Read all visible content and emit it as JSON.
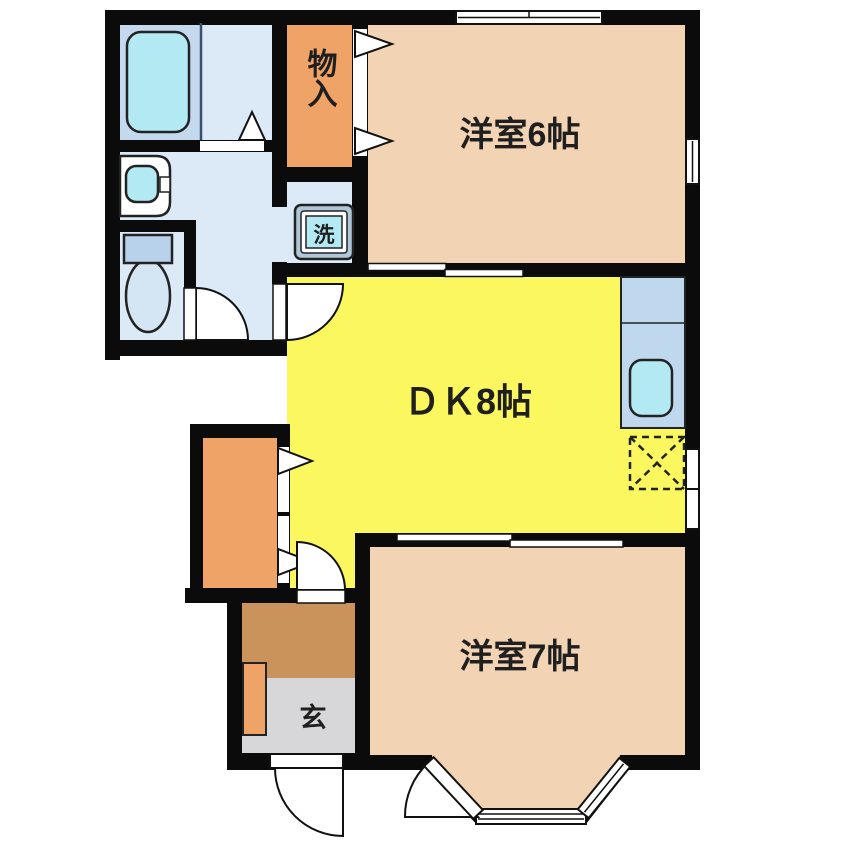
{
  "floor_plan": {
    "rooms": {
      "western6": {
        "label": "洋室6帖"
      },
      "dk": {
        "label": "ＤＫ8帖"
      },
      "western7": {
        "label": "洋室7帖"
      },
      "storage": {
        "label": "物入"
      },
      "laundry": {
        "label": "洗"
      },
      "entrance": {
        "label": "玄"
      }
    },
    "palette": {
      "wall": "#0B0B0B",
      "opening": "#FFFFFF",
      "text": "#1F1F1F",
      "peach": "#F2D3B3",
      "yellow": "#FAF75F",
      "orange": "#EFA367",
      "brown": "#C9935B",
      "gray": "#D7D7D9",
      "washroom_blue": "#DCE9F6",
      "bathroom_blue": "#C5D9EE",
      "fixture_cyan": "#B2E9F3",
      "counter_blue": "#BFD8EE",
      "toilet_tank_blue": "#B9D2EC",
      "toilet_bowl_blue": "#D4E6F4",
      "washer_frame_blue": "#AFC7D8"
    }
  }
}
